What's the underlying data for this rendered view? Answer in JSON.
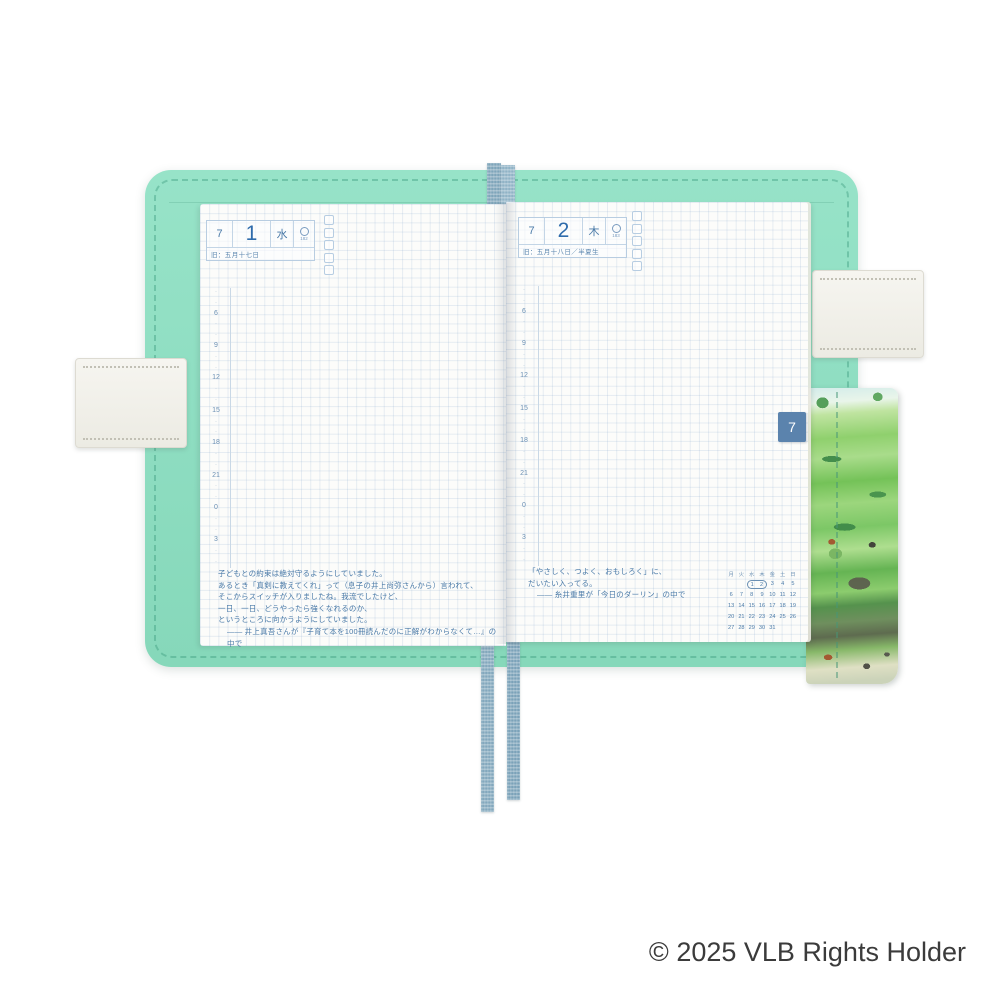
{
  "product": {
    "description": "open planner spread July 1-2 in mint fabric cover",
    "footer_copyright": "© 2025 VLB Rights Holder"
  },
  "theme": {
    "cover_mint": "#8fdec2",
    "page_white": "#fcfcfa",
    "ink_blue": "#4a7aa8",
    "day_blue": "#2f6cac",
    "tab_blue": "#5b83ad",
    "ribbon_blue": "#83a8bd",
    "strap_cream": "#f3f2ed",
    "copy_gray": "#3b3b3b"
  },
  "month_tab": "7",
  "time_track": [
    "6",
    "9",
    "12",
    "15",
    "18",
    "21",
    "0",
    "3"
  ],
  "left_page": {
    "month": "7",
    "day": "1",
    "weekday": "水",
    "day_of_year": "182",
    "moon_icon": "moon-phase-circle",
    "old_calendar": "旧：五月十七日",
    "quote_lines": [
      "子どもとの約束は絶対守るようにしていました。",
      "あるとき「真剣に教えてくれ」って（息子の井上尚弥さんから）言われて、",
      "そこからスイッチが入りましたね。我流でしたけど、",
      "一日、一日、どうやったら強くなれるのか、",
      "というところに向かうようにしていました。",
      "―― 井上真吾さんが『子育て本を100冊読んだのに正解がわからなくて…』の中で"
    ]
  },
  "right_page": {
    "month": "7",
    "day": "2",
    "weekday": "木",
    "day_of_year": "183",
    "moon_icon": "moon-phase-circle",
    "old_calendar": "旧：五月十八日／半夏生",
    "quote_lines": [
      "「やさしく、つよく、おもしろく」に、",
      "だいたい入ってる。",
      "―― 糸井重里が「今日のダーリン」の中で"
    ],
    "mini_calendar": {
      "day_headers": [
        "月",
        "火",
        "水",
        "木",
        "金",
        "土",
        "日"
      ],
      "weeks": [
        [
          "",
          "",
          "1",
          "2",
          "3",
          "4",
          "5"
        ],
        [
          "6",
          "7",
          "8",
          "9",
          "10",
          "11",
          "12"
        ],
        [
          "13",
          "14",
          "15",
          "16",
          "17",
          "18",
          "19"
        ],
        [
          "20",
          "21",
          "22",
          "23",
          "24",
          "25",
          "26"
        ],
        [
          "27",
          "28",
          "29",
          "30",
          "31",
          "",
          ""
        ]
      ],
      "highlighted_days": [
        "1",
        "2"
      ]
    }
  }
}
